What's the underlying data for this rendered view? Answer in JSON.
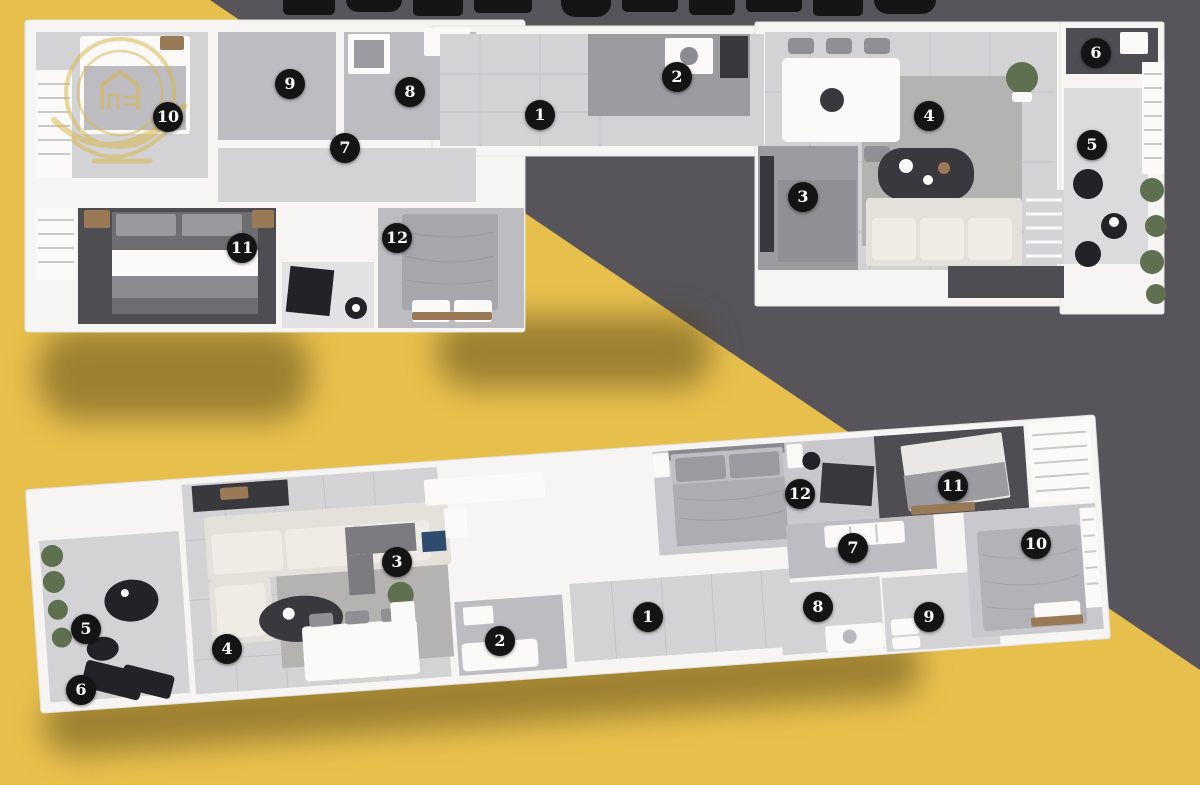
{
  "poster": {
    "kind": "3d-floor-plan-poster",
    "title_fully_visible": "no",
    "marker_style": "black circle with white serif numeral"
  },
  "palette": {
    "background_yellow": "#E7BF4C",
    "background_dark": "#57555A",
    "marker_bg": "#141414",
    "marker_text": "#FFFFFF",
    "wall_white": "#F6F5F3",
    "floor_light": "#D3D2D5",
    "floor_dark": "#4E4D52",
    "sofa_beige": "#E4E1DA",
    "plant_green": "#5E7050",
    "watermark_gold": "#D8B64A"
  },
  "plans": {
    "upper": {
      "name": "upper apartment floor plan",
      "markers": [
        {
          "n": "10",
          "x": 168,
          "y": 117
        },
        {
          "n": "9",
          "x": 290,
          "y": 84
        },
        {
          "n": "8",
          "x": 410,
          "y": 92
        },
        {
          "n": "7",
          "x": 345,
          "y": 148
        },
        {
          "n": "1",
          "x": 540,
          "y": 115
        },
        {
          "n": "2",
          "x": 677,
          "y": 77
        },
        {
          "n": "4",
          "x": 929,
          "y": 116
        },
        {
          "n": "6",
          "x": 1096,
          "y": 53
        },
        {
          "n": "5",
          "x": 1092,
          "y": 145
        },
        {
          "n": "3",
          "x": 803,
          "y": 197
        },
        {
          "n": "11",
          "x": 242,
          "y": 248
        },
        {
          "n": "12",
          "x": 397,
          "y": 238
        }
      ]
    },
    "lower": {
      "name": "lower apartment floor plan",
      "markers": [
        {
          "n": "5",
          "x": 86,
          "y": 629
        },
        {
          "n": "6",
          "x": 81,
          "y": 690
        },
        {
          "n": "4",
          "x": 227,
          "y": 649
        },
        {
          "n": "3",
          "x": 397,
          "y": 562
        },
        {
          "n": "2",
          "x": 500,
          "y": 641
        },
        {
          "n": "1",
          "x": 648,
          "y": 617
        },
        {
          "n": "12",
          "x": 800,
          "y": 494
        },
        {
          "n": "11",
          "x": 953,
          "y": 486
        },
        {
          "n": "7",
          "x": 853,
          "y": 548
        },
        {
          "n": "10",
          "x": 1036,
          "y": 544
        },
        {
          "n": "8",
          "x": 818,
          "y": 607
        },
        {
          "n": "9",
          "x": 929,
          "y": 617
        }
      ]
    }
  }
}
